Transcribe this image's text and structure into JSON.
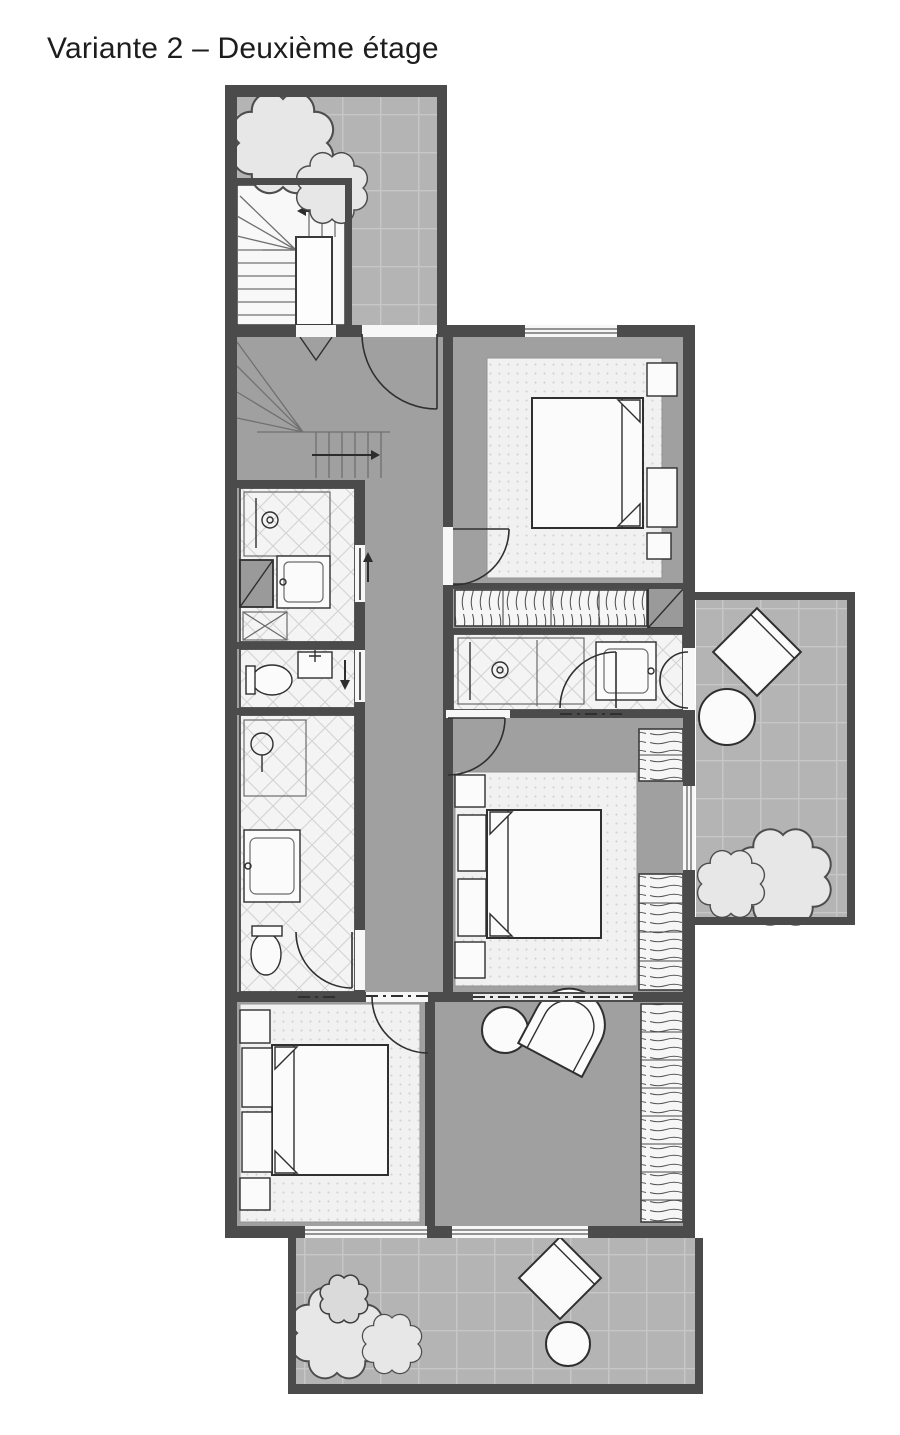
{
  "title": "Variante 2 – Deuxième étage",
  "palette": {
    "paper": "#ffffff",
    "ink": "#1d1d1d",
    "wall": "#4b4b4b",
    "line": "#2f2f2f",
    "floor": "#a0a0a0",
    "terrace": "#b4b4b4",
    "terrace_line": "#c7c7c7",
    "tile": "#f4f4f4",
    "tile_line": "#d3d3d3",
    "carpet": "#f1f1f1",
    "carpet_dot": "#cfcfcf",
    "furniture": "#fbfbfb",
    "tree": "#e7e7e7",
    "shaft": "#9a9a9a",
    "opening": "#f7f7f7"
  }
}
